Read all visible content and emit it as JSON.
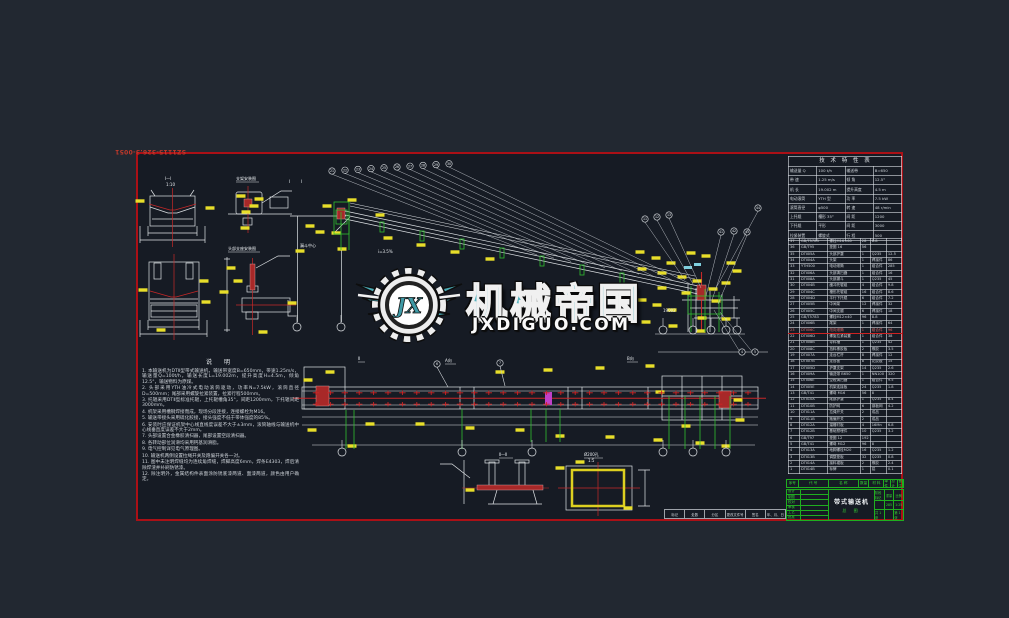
{
  "colors": {
    "sheet_bg": "#161b24",
    "page_bg": "#222831",
    "border_red": "#ab1016",
    "cad_white": "#dfe3e6",
    "cad_yellow": "#e8de2a",
    "cad_green": "#2fbf2f",
    "cad_red": "#c62828",
    "cad_magenta": "#c040c8",
    "watermark_teal": "#55b2bd",
    "titleblock_green": "#1fae1f"
  },
  "drawing_number": "SZ1115-326.3-0051",
  "watermark": {
    "brand": "机械帝国",
    "domain": "JXDIGUO.COM",
    "logo_initials": "JX"
  },
  "notes": {
    "title": "说  明",
    "lines": [
      "1. 本输送机为DTⅡ型带式输送机，输送带宽度B=650mm，带速1.25m/s，输送量Q=100t/h，输送长度L=19.002m，提升高度H=4.5m，倾角12.5°，输送物料为原煤。",
      "2. 头部采用YTH油冷式电动滚筒驱动，功率N=7.5kW，滚筒直径D=500mm；尾部采用螺旋拉紧装置，拉紧行程500mm。",
      "3. 托辊采用DTⅡ型标准托辊，上托辊槽角35°，间距1200mm，下托辊间距3000mm。",
      "4. 机架采用槽钢焊接而成，现场分段连接，连接螺栓为M16。",
      "5. 输送带接头采用硫化胶接，接头强度不低于带体强度的85%。",
      "6. 安装时应保证机架中心线直线度误差不大于±3mm，滚筒轴线与输送机中心线垂直度误差不大于2mm。",
      "7. 头部设置合金橡胶清扫器，尾部设置空段清扫器。",
      "8. 各转动部位润滑均采用钙基润滑脂。",
      "9. 电气控制详见电气原理图。",
      "10. 输送机两侧设置拉绳开关及跑偏开关各一对。",
      "11. 图中未注明焊缝均为连续角焊缝，焊脚高度6mm，焊条E4303，焊后清除焊渣并补刷防锈漆。",
      "12. 除注明外，金属结构件表面涂防锈底漆两道、面漆两道，颜色由用户确定。"
    ]
  },
  "tech_table": {
    "title": "技 术 特 性 表",
    "rows": [
      [
        "输送量 Q",
        "100 t/h",
        "输送带",
        "B=650"
      ],
      [
        "带  速",
        "1.25 m/s",
        "倾  角",
        "12.5°"
      ],
      [
        "机  长",
        "19.002 m",
        "提升高度",
        "4.5 m"
      ],
      [
        "电动滚筒",
        "YTH 型",
        "功  率",
        "7.5 kW"
      ],
      [
        "滚筒直径",
        "φ500",
        "转  速",
        "48 r/min"
      ],
      [
        "上托辊",
        "槽形 35°",
        "间  距",
        "1200"
      ],
      [
        "下托辊",
        "平形",
        "间  距",
        "3000"
      ],
      [
        "拉紧装置",
        "螺旋式",
        "行  程",
        "500"
      ]
    ]
  },
  "bom": {
    "red_row_index": 14,
    "rows": [
      [
        "37",
        "GB/T5783",
        "螺栓M16×60",
        "28",
        "8.8",
        ""
      ],
      [
        "36",
        "GB/T95",
        "垫圈 16",
        "56",
        "",
        ""
      ],
      [
        "35",
        "DTⅡ05A",
        "头部护罩",
        "1",
        "Q235",
        "12.5"
      ],
      [
        "34",
        "DTⅡ04A",
        "头架",
        "1",
        "焊接件",
        "86"
      ],
      [
        "33",
        "YTH500",
        "电动滚筒",
        "1",
        "组合件",
        "285"
      ],
      [
        "32",
        "DTⅡ06A",
        "头部清扫器",
        "1",
        "组合件",
        "16"
      ],
      [
        "31",
        "DTⅡ08A",
        "头部漏斗",
        "1",
        "Q235",
        "45"
      ],
      [
        "30",
        "DTⅡ04B",
        "缓冲托辊组",
        "4",
        "组合件",
        "9.8"
      ],
      [
        "29",
        "DTⅡ04C",
        "槽形托辊组",
        "16",
        "组合件",
        "8.6"
      ],
      [
        "28",
        "DTⅡ04D",
        "平行下托辊",
        "6",
        "组合件",
        "7.2"
      ],
      [
        "27",
        "DTⅡ05B",
        "中间架",
        "12",
        "焊接件",
        "32"
      ],
      [
        "26",
        "DTⅡ05C",
        "中间支腿",
        "6",
        "焊接件",
        "18"
      ],
      [
        "25",
        "GB/T5783",
        "螺栓M12×40",
        "96",
        "8.8",
        ""
      ],
      [
        "24",
        "DTⅡ06B",
        "尾架",
        "1",
        "焊接件",
        "64"
      ],
      [
        "23",
        "DTⅡ06C",
        "改向滚筒",
        "1",
        "组合件",
        "96"
      ],
      [
        "22",
        "DTⅡ06D",
        "螺旋拉紧装置",
        "1",
        "组合件",
        "38"
      ],
      [
        "21",
        "DTⅡ08B",
        "导料槽",
        "1",
        "Q235",
        "42"
      ],
      [
        "20",
        "DTⅡ08C",
        "挡料橡胶板",
        "2",
        "橡胶",
        "3.5"
      ],
      [
        "19",
        "DTⅡ07A",
        "走台栏杆",
        "8",
        "焊接件",
        "12"
      ],
      [
        "18",
        "DTⅡ07B",
        "走台板",
        "8",
        "花纹板",
        "15"
      ],
      [
        "17",
        "DTⅡ05D",
        "护罩支架",
        "14",
        "Q235",
        "2.6"
      ],
      [
        "16",
        "DTⅡ09A",
        "输送带 B650",
        "1",
        "NN100",
        "320"
      ],
      [
        "15",
        "DTⅡ06E",
        "空段清扫器",
        "1",
        "组合件",
        "9.5"
      ],
      [
        "14",
        "DTⅡ05E",
        "机架连接板",
        "24",
        "Q235",
        "1.8"
      ],
      [
        "13",
        "GB/T41",
        "螺母 M16",
        "56",
        "8",
        ""
      ],
      [
        "12",
        "DTⅡ10A",
        "尾部护罩",
        "1",
        "Q235",
        "8.4"
      ],
      [
        "11",
        "DTⅡ10B",
        "防护网",
        "6",
        "钢板网",
        "4.2"
      ],
      [
        "10",
        "DTⅡ11A",
        "拉绳开关",
        "2",
        "成品",
        ""
      ],
      [
        "9",
        "DTⅡ11B",
        "跑偏开关",
        "2",
        "成品",
        ""
      ],
      [
        "8",
        "DTⅡ12A",
        "溜槽衬板",
        "4",
        "16Mn",
        "6.8"
      ],
      [
        "7",
        "DTⅡ12B",
        "基础预埋件",
        "10",
        "Q235",
        "3.2"
      ],
      [
        "6",
        "GB/T97",
        "垫圈 12",
        "192",
        "",
        ""
      ],
      [
        "5",
        "GB/T41",
        "螺母 M12",
        "96",
        "8",
        ""
      ],
      [
        "4",
        "DTⅡ13A",
        "地脚螺栓M20",
        "16",
        "Q235",
        "1.2"
      ],
      [
        "3",
        "DTⅡ13B",
        "调整垫板",
        "32",
        "Q235",
        "0.8"
      ],
      [
        "2",
        "DTⅡ14A",
        "接料裙板",
        "2",
        "橡胶",
        "2.4"
      ],
      [
        "1",
        "DTⅡ14B",
        "标牌",
        "1",
        "铝",
        "0.1"
      ]
    ]
  },
  "bom_header": [
    "序号",
    "代  号",
    "名  称",
    "数量",
    "材 料",
    "单件",
    "总计",
    "备注"
  ],
  "title_block": {
    "title": "带式输送机",
    "subtitle": "总  图",
    "left_rows": [
      "设计",
      "制图",
      "校对",
      "审核",
      "工艺",
      "批准"
    ],
    "right_rows": [
      [
        "阶段标记",
        "重量",
        "比例"
      ],
      [
        "",
        "285",
        "1:25"
      ],
      [
        "共 1 张",
        "",
        "第 1 张"
      ]
    ]
  },
  "revision_strip": [
    "标记",
    "处数",
    "分区",
    "更改文件号",
    "签名",
    "年、月、日"
  ],
  "annotations": {
    "sec_a": "Ⅰ—Ⅰ",
    "scale_a": "1:10",
    "det_c": "支架安装图",
    "det_d": "头部支座安装图",
    "hopper": "漏斗中心",
    "len": "19002",
    "slope": "i=3.5%",
    "det_e": "Ⅱ—Ⅱ",
    "det_f": "Ø200孔",
    "det_f_s": "1:5",
    "view_a": "A向",
    "view_b": "B向",
    "view_m": "Ⅱ",
    "cut1": "Ⅰ",
    "cut2": "Ⅰ"
  }
}
